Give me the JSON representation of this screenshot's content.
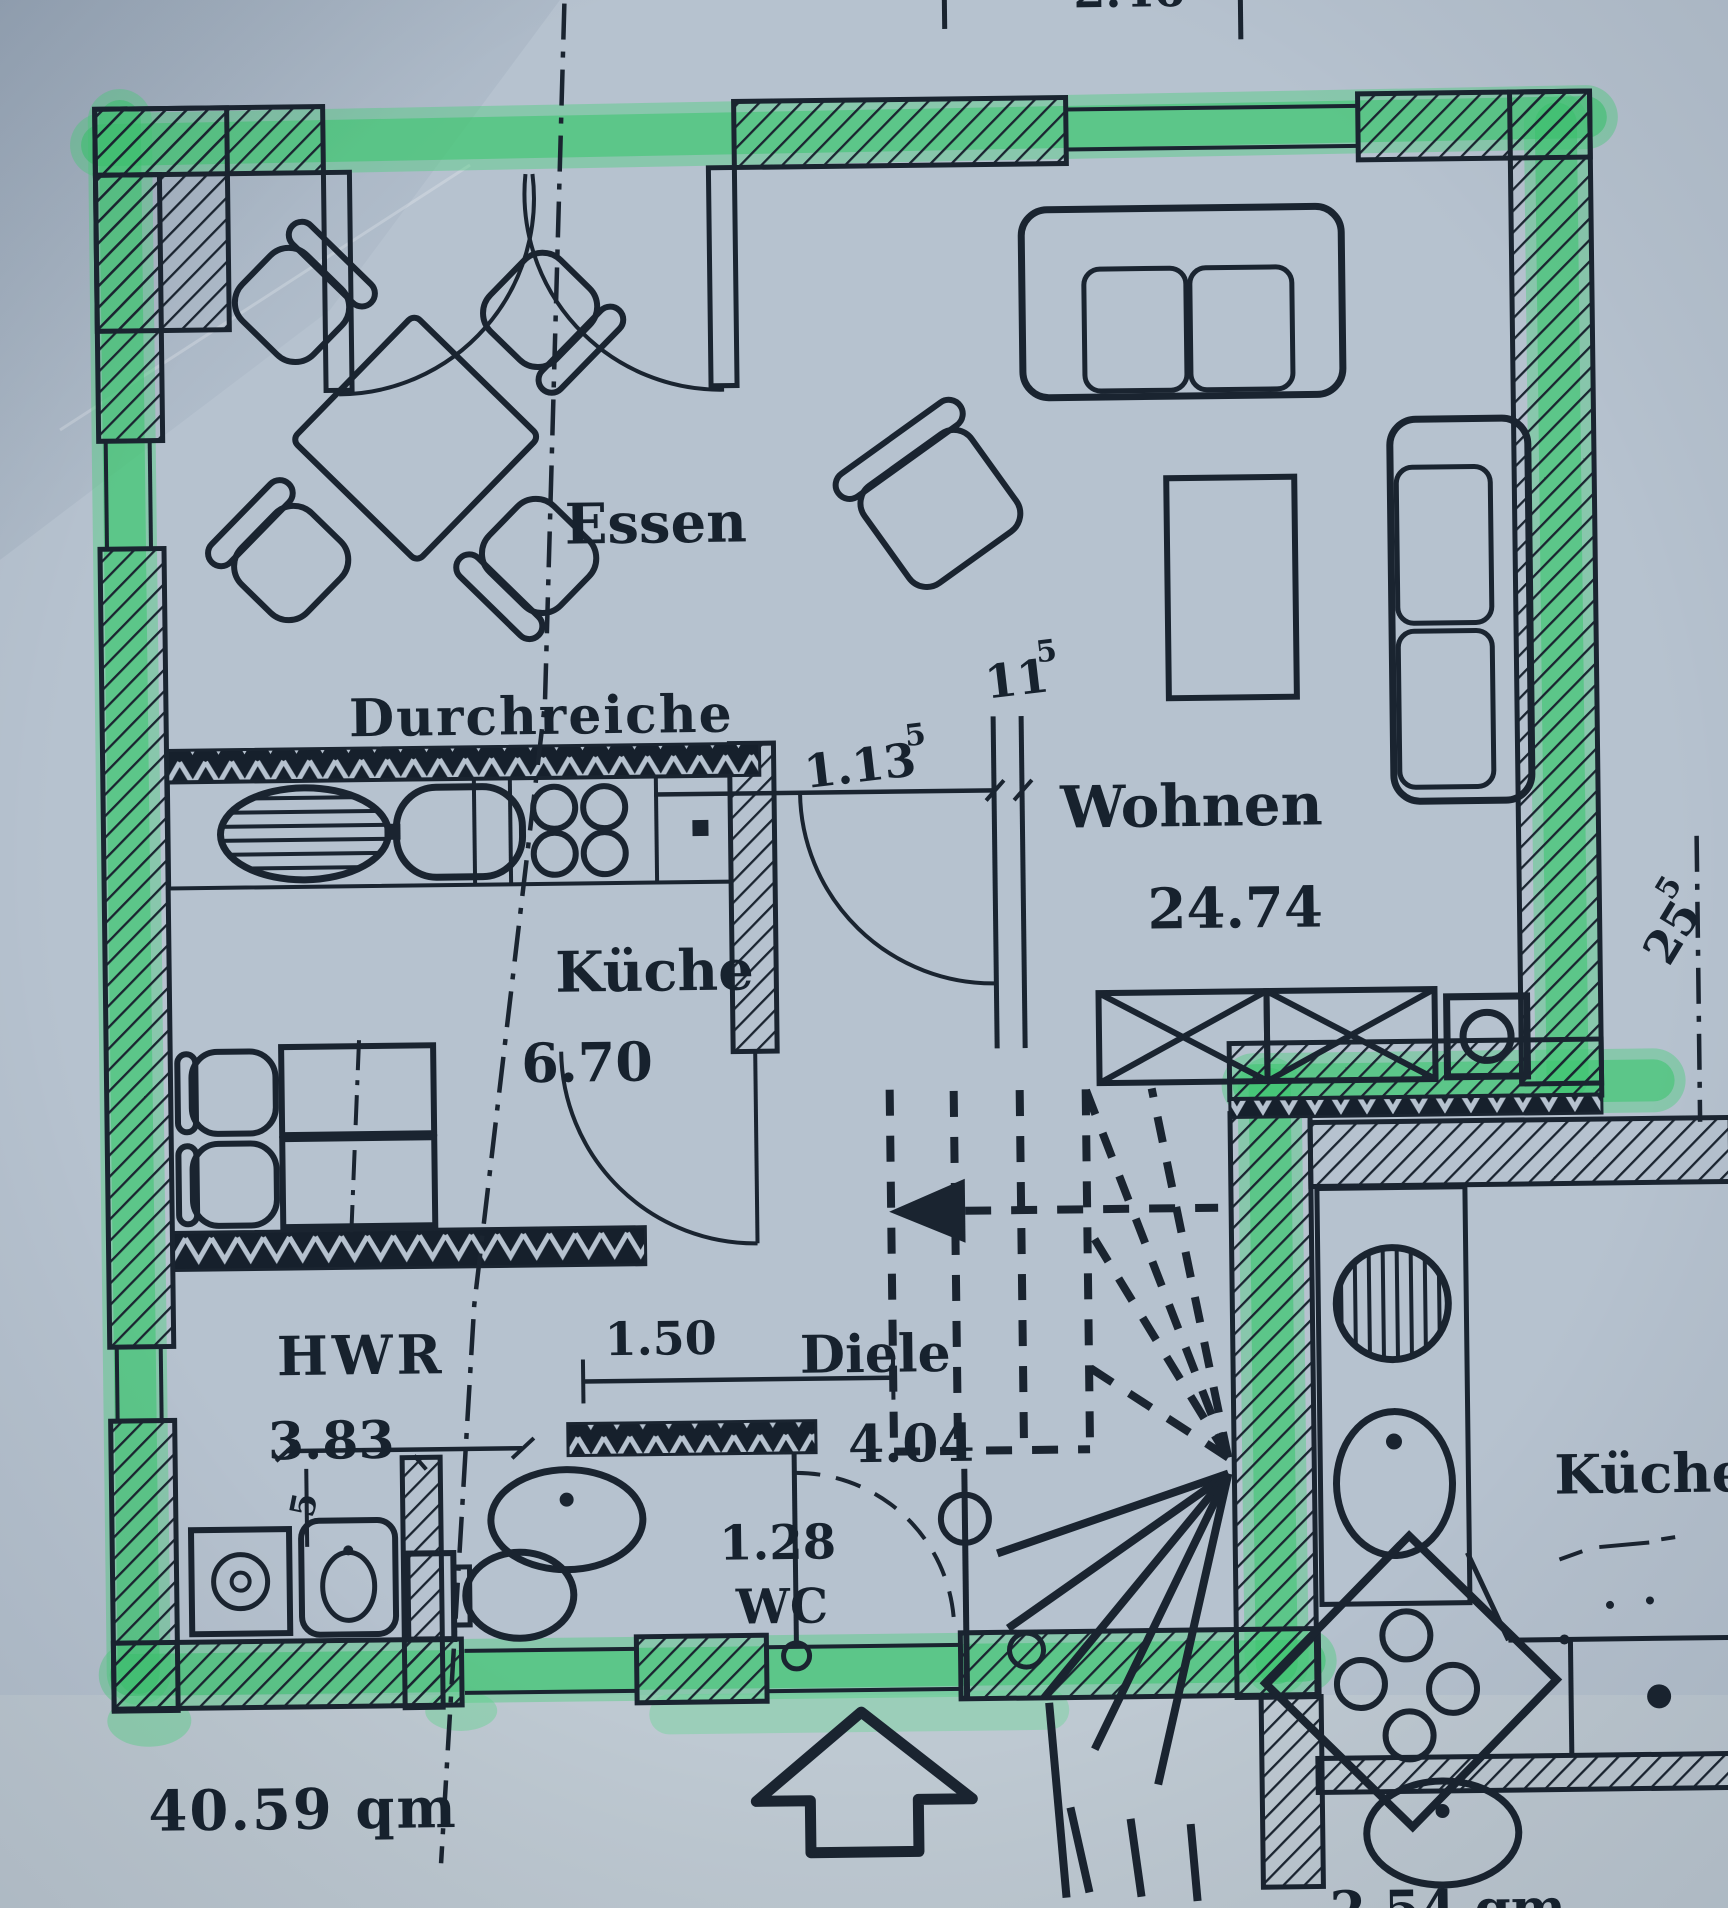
{
  "photo": {
    "description": "scanned architectural floor plan, apartment outlined with green highlighter"
  },
  "colors": {
    "paper": "#b6c2cf",
    "ink": "#1a2430",
    "highlighter_green": "#3fc471"
  },
  "rooms": {
    "essen": {
      "label": "Essen"
    },
    "wohnen": {
      "label": "Wohnen",
      "area": "24.74"
    },
    "kueche": {
      "label": "Küche",
      "area": "6.70"
    },
    "hwr": {
      "label": "HWR",
      "area": "3.83"
    },
    "diele": {
      "label": "Diele",
      "area": "4.04"
    },
    "wc": {
      "label": "WC",
      "area": "1.28"
    },
    "neighbor_kueche": {
      "label": "Küche"
    }
  },
  "labels": {
    "durchreiche": "Durchreiche",
    "total_area": "40.59  qm"
  },
  "dimensions": {
    "opening_width": "1.13",
    "opening_width_sup": "5",
    "wall_thickness": "11",
    "wall_thickness_sup": "5",
    "diele_width": "1.50",
    "rotated_right": "25",
    "rotated_right_sup": "5",
    "hwr_small": "5",
    "partial_top": "2.46",
    "partial_bottom": "2.54 qm"
  }
}
